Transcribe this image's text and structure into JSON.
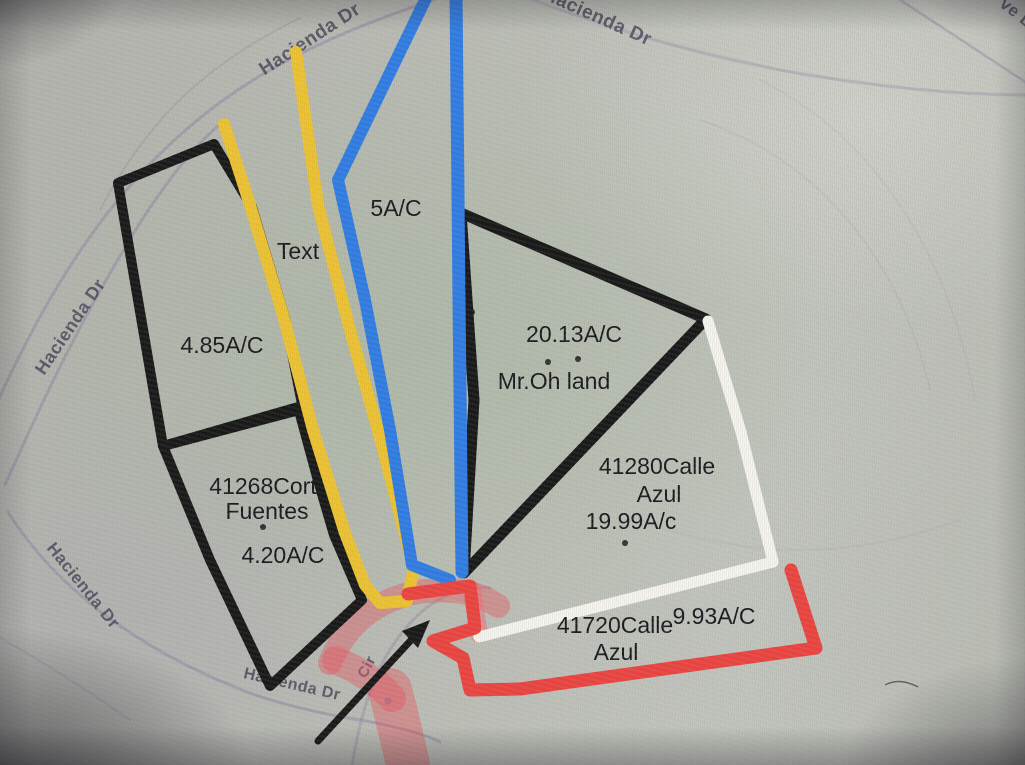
{
  "colors": {
    "map_background": "#bcbeb6",
    "parcel_outline_black": "#161616",
    "overlay_yellow": "#f0c32d",
    "overlay_blue": "#2d7ce8",
    "overlay_white": "#f7f5f0",
    "overlay_red": "#f0413e",
    "overlay_red_translucent": "rgba(236,82,92,0.42)",
    "overlay_red_translucent_strong": "rgba(242,105,115,0.5)",
    "street_label": "#4a4159",
    "annotation_text": "#17171c",
    "road_purple": "#8e84a4",
    "map_marker_blue": "#5b8fd6"
  },
  "streets": {
    "hacienda_dr_top_left": "Hacienda Dr",
    "hacienda_dr_top_right": "Hacienda Dr",
    "hacienda_dr_mid_left": "Hacienda Dr",
    "hacienda_dr_bottom_left": "Hacienda Dr",
    "hacienda_dr_bottom_center": "Hacienda Dr",
    "cir_street_partial": "Cir",
    "corner_street_partial": "ve L"
  },
  "parcels": {
    "five_ac_strip": {
      "area": "5A/C"
    },
    "text_placeholder": {
      "label": "Text"
    },
    "west_upper": {
      "area": "4.85A/C"
    },
    "mr_oh": {
      "area": "20.13A/C",
      "owner": "Mr.Oh land"
    },
    "corte_fuentes": {
      "address_line1": "41268Cort",
      "address_line2": "Fuentes",
      "area": "4.20A/C"
    },
    "calle_azul_east": {
      "address_line1": "41280Calle",
      "address_line2": "Azul",
      "area": "19.99A/c"
    },
    "calle_azul_south": {
      "address_line1": "41720Calle",
      "address_line2": "Azul",
      "area": "9.93A/C"
    }
  }
}
